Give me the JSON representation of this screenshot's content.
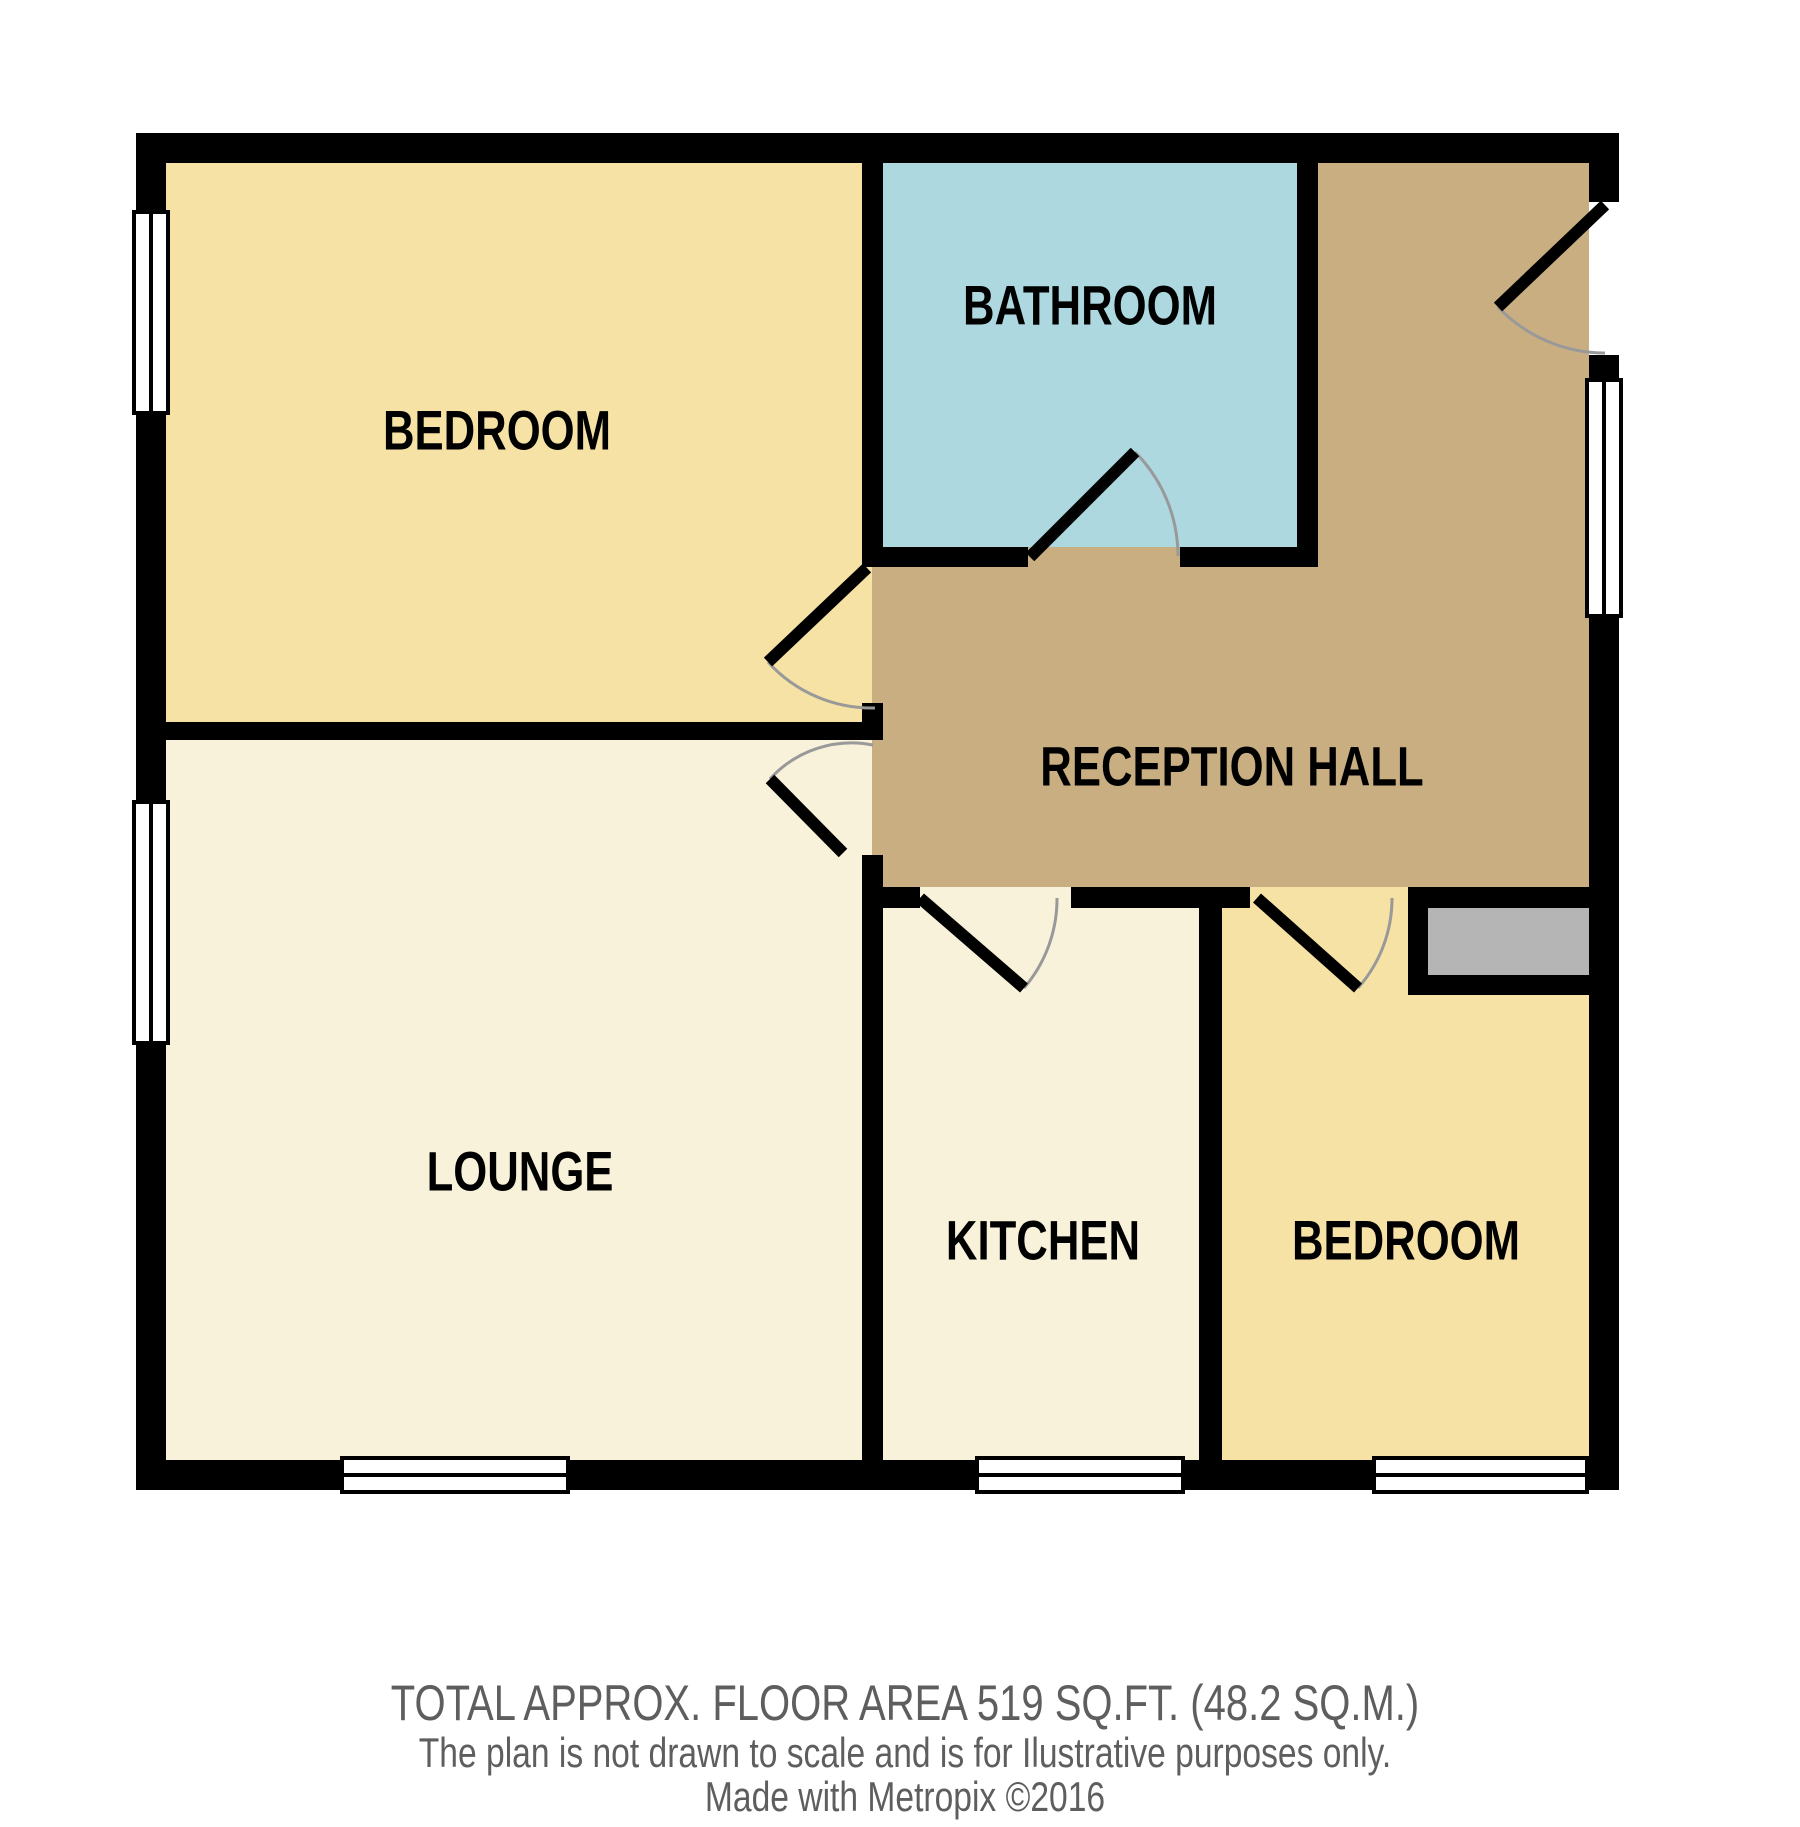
{
  "plan": {
    "rooms": [
      {
        "id": "bedroom-top",
        "label": "BEDROOM",
        "color": "#F6E2A4"
      },
      {
        "id": "bathroom",
        "label": "BATHROOM",
        "color": "#ADD8E0"
      },
      {
        "id": "reception-hall",
        "label": "RECEPTION HALL",
        "color": "#C9AE82"
      },
      {
        "id": "lounge",
        "label": "LOUNGE",
        "color": "#F8F2DA"
      },
      {
        "id": "kitchen",
        "label": "KITCHEN",
        "color": "#F8F2DA"
      },
      {
        "id": "bedroom-right",
        "label": "BEDROOM",
        "color": "#F6E2A4"
      }
    ],
    "storage_color": "#B5B5B5",
    "wall_color": "#000000",
    "window_color": "#FFFFFF",
    "door_leaf_color": "#000000",
    "door_arc_color": "#999999"
  },
  "footer": {
    "area_line": "TOTAL APPROX. FLOOR AREA 519 SQ.FT. (48.2 SQ.M.)",
    "disclaimer_line": "The plan is not drawn to scale and is for Ilustrative purposes only.",
    "credit_line": "Made with Metropix ©2016",
    "text_color": "#5E5E5E"
  }
}
